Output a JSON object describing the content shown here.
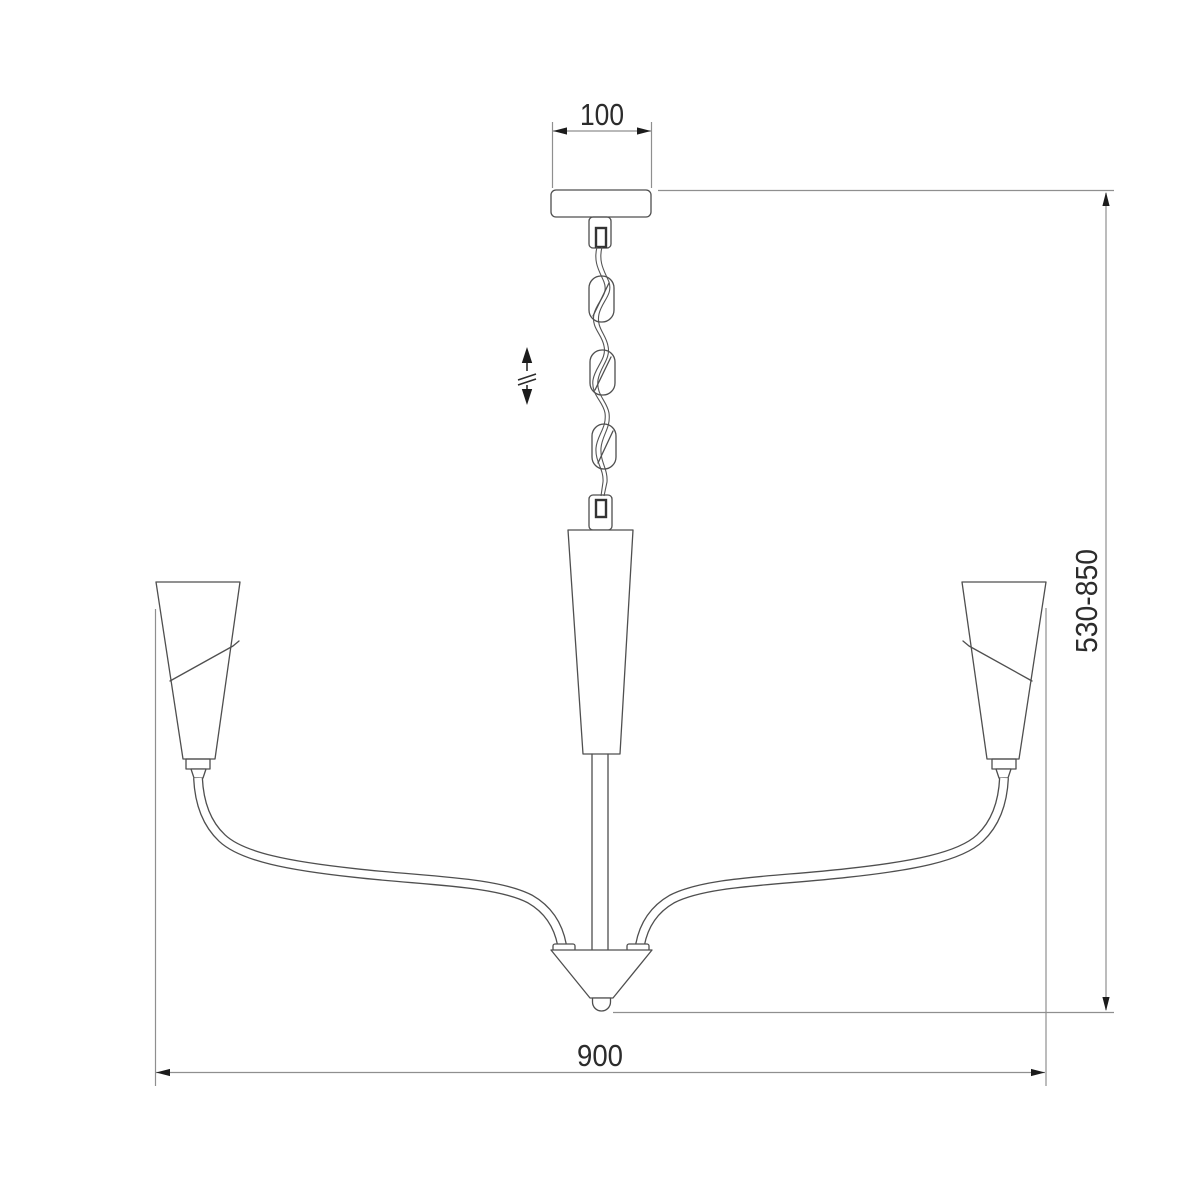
{
  "diagram": {
    "type": "technical-dimension-drawing",
    "subject": "chandelier-side-elevation",
    "background_color": "#ffffff",
    "colors": {
      "object_line": "#4f4f4f",
      "dimension_line": "#8f8f8f",
      "arrow_fill": "#1c1c1c",
      "text": "#2c2c2c"
    },
    "dimensions": {
      "canopy_width": {
        "label": "100"
      },
      "height_range": {
        "label": "530-850"
      },
      "overall_width": {
        "label": "900"
      }
    },
    "symbols": {
      "height_adjustable": "double-headed vertical arrow with break marks"
    }
  }
}
